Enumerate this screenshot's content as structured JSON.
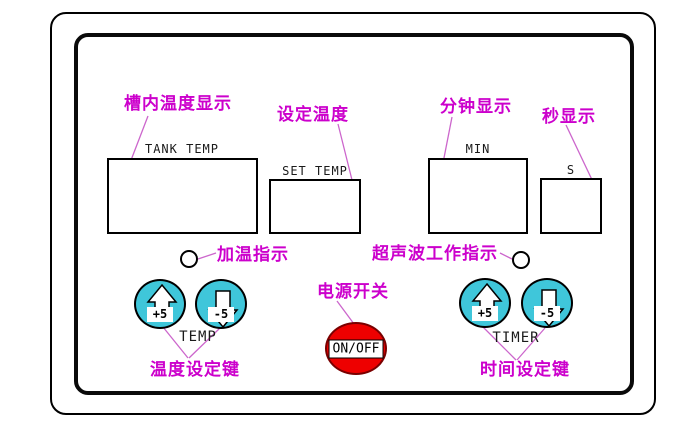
{
  "panel": {
    "type": "ultrasonic-cleaner-control-panel-diagram",
    "displays": [
      {
        "id": "tank_temp",
        "label": "TANK TEMP",
        "annotation": "槽内温度显示"
      },
      {
        "id": "set_temp",
        "label": "SET TEMP",
        "annotation": "设定温度"
      },
      {
        "id": "min",
        "label": "MIN",
        "annotation": "分钟显示"
      },
      {
        "id": "sec",
        "label": "S",
        "annotation": "秒显示"
      }
    ],
    "indicators": [
      {
        "id": "heating",
        "annotation": "加温指示"
      },
      {
        "id": "ultrasonic",
        "annotation": "超声波工作指示"
      }
    ],
    "power": {
      "label": "ON/OFF",
      "annotation": "电源开关"
    },
    "temp_keys": {
      "group_label": "TEMP",
      "up": "+5",
      "down": "-5",
      "annotation": "温度设定键"
    },
    "timer_keys": {
      "group_label": "TIMER",
      "up": "+5",
      "down": "-5",
      "annotation": "时间设定键"
    },
    "colors": {
      "annotation_magenta": "#cc00cc",
      "leader_pink": "#cc66cc",
      "key_cyan": "#3fc6da",
      "power_red": "#ee0000",
      "line_black": "#000000"
    }
  }
}
